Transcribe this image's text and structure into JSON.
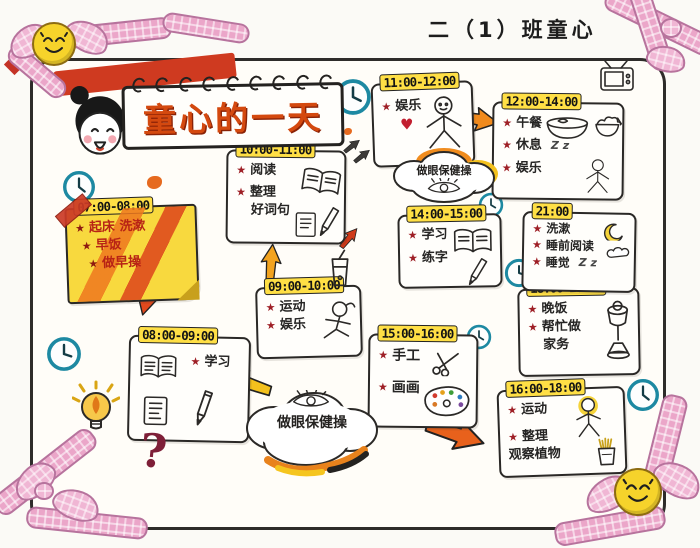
{
  "header": {
    "class_label": "二（1）班童心"
  },
  "title": {
    "text": "童心的一天"
  },
  "clouds": {
    "top": {
      "text": "做眼保健操"
    },
    "bottom": {
      "text": "做眼保健操"
    }
  },
  "decorations": {
    "star": "★",
    "question_mark": "?",
    "sleep_z": "Z z",
    "heart": "♥"
  },
  "colors": {
    "highlight_yellow": "#ffdf45",
    "sticky_yellow": "#f8d93e",
    "clock_teal": "#1d89a2",
    "ribbon_pink": "#eba6c9",
    "star_red": "#9e1f26",
    "arrow_orange": "#f08a1d",
    "title_orange_red": "#d4490f"
  },
  "blocks": [
    {
      "time": "07:00-08:00",
      "lines": [
        {
          "star": true,
          "text": "起床 洗漱"
        },
        {
          "star": true,
          "text": "早饭"
        },
        {
          "star": true,
          "text": "做早操"
        }
      ]
    },
    {
      "time": "08:00-09:00",
      "lines": [
        {
          "star": true,
          "text": "学习"
        }
      ]
    },
    {
      "time": "09:00-10:00",
      "lines": [
        {
          "star": true,
          "text": "运动"
        },
        {
          "star": true,
          "text": "娱乐"
        }
      ]
    },
    {
      "time": "10:00-11:00",
      "lines": [
        {
          "star": true,
          "text": "阅读"
        },
        {
          "star": true,
          "text": "整理"
        },
        {
          "star": false,
          "text": "好词句"
        }
      ]
    },
    {
      "time": "11:00-12:00",
      "lines": [
        {
          "star": true,
          "text": "娱乐"
        }
      ]
    },
    {
      "time": "12:00-14:00",
      "lines": [
        {
          "star": true,
          "text": "午餐"
        },
        {
          "star": true,
          "text": "休息"
        },
        {
          "star": true,
          "text": "娱乐"
        }
      ]
    },
    {
      "time": "14:00-15:00",
      "lines": [
        {
          "star": true,
          "text": "学习"
        },
        {
          "star": true,
          "text": "练字"
        }
      ]
    },
    {
      "time": "15:00-16:00",
      "lines": [
        {
          "star": true,
          "text": "手工"
        },
        {
          "star": true,
          "text": "画画"
        }
      ]
    },
    {
      "time": "16:00-18:00",
      "lines": [
        {
          "star": true,
          "text": "运动"
        },
        {
          "star": true,
          "text": "整理"
        },
        {
          "star": false,
          "text": "观察植物"
        }
      ]
    },
    {
      "time": "18:00-20:00",
      "lines": [
        {
          "star": true,
          "text": "晚饭"
        },
        {
          "star": true,
          "text": "帮忙做"
        },
        {
          "star": false,
          "text": "家务"
        }
      ]
    },
    {
      "time": "21:00",
      "lines": [
        {
          "star": true,
          "text": "洗漱"
        },
        {
          "star": true,
          "text": "睡前阅读"
        },
        {
          "star": true,
          "text": "睡觉"
        }
      ]
    }
  ]
}
